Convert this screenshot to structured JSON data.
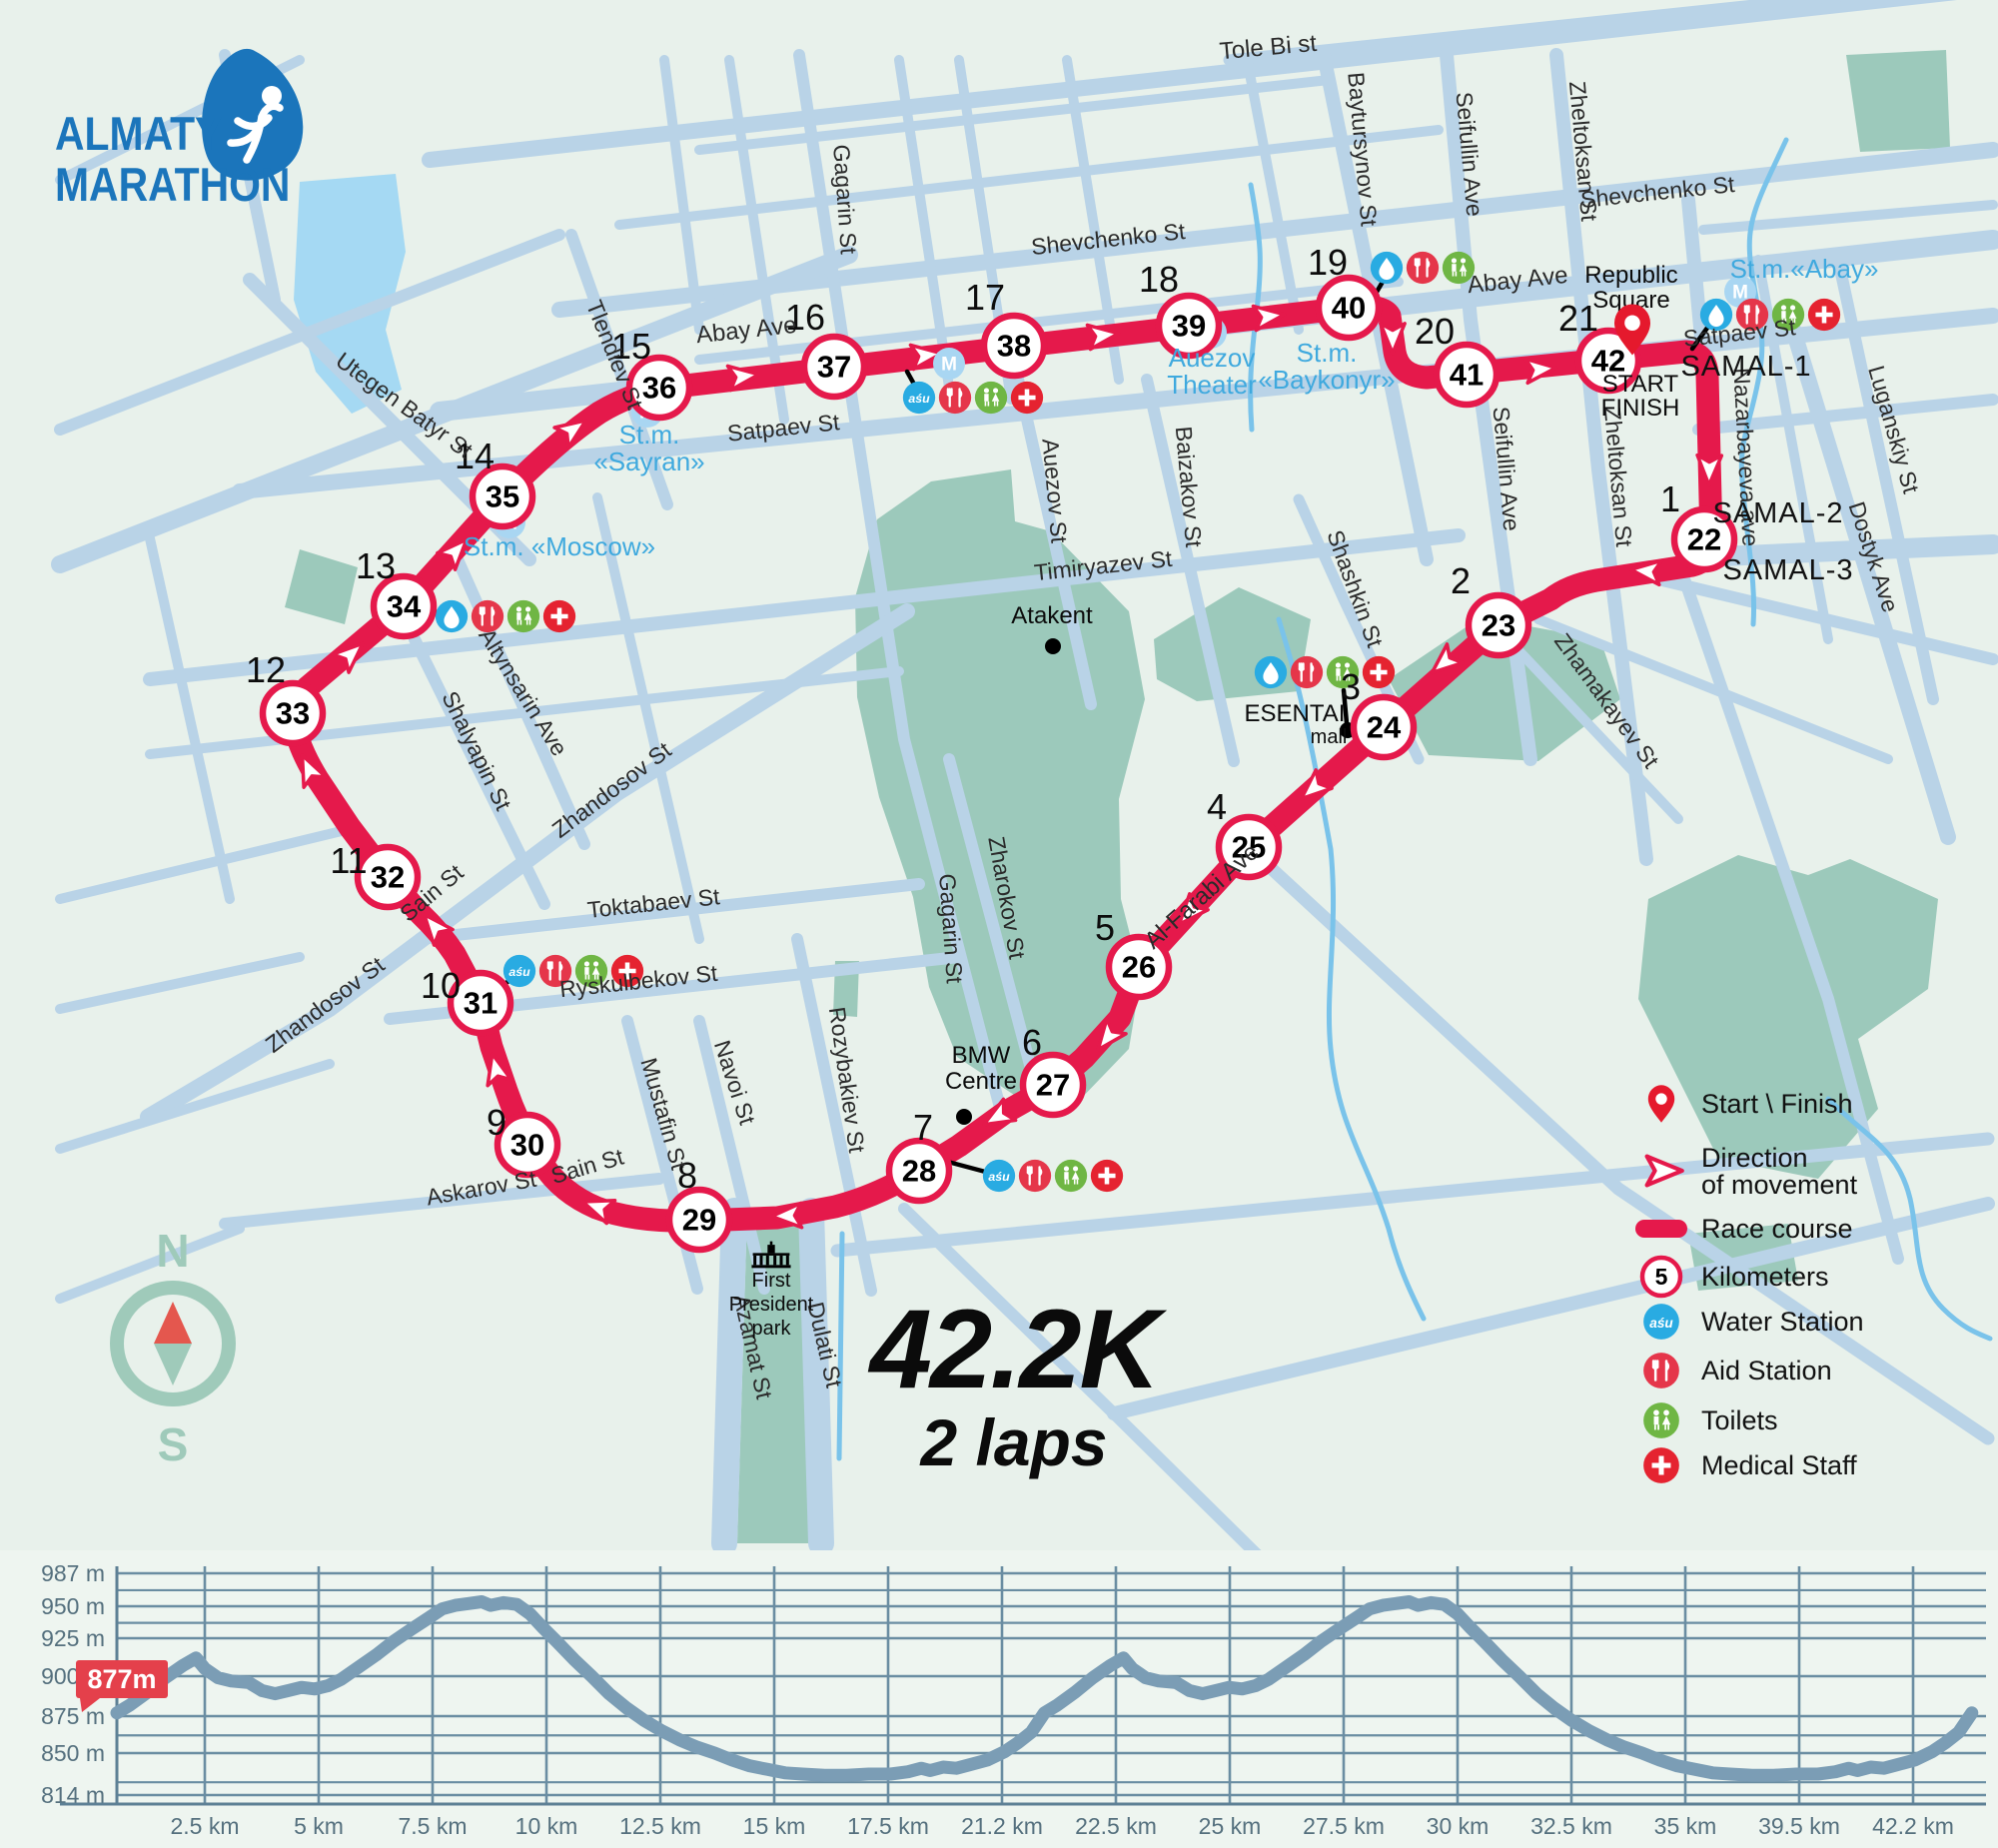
{
  "logo": {
    "line1": "ALMATY",
    "line2": "MARATHON"
  },
  "title": {
    "distance": "42.2K",
    "laps": "2 laps"
  },
  "compass": {
    "north": "N",
    "south": "S"
  },
  "legend": {
    "items": [
      {
        "icon": "pin",
        "label": "Start \\ Finish",
        "y": 1105
      },
      {
        "icon": "dir",
        "label": "Direction\nof movement",
        "y": 1172
      },
      {
        "icon": "bar",
        "label": "Race course",
        "y": 1230
      },
      {
        "icon": "km",
        "label": "Kilometers",
        "badge": "5",
        "y": 1278
      },
      {
        "icon": "asu",
        "label": "Water Station",
        "y": 1323
      },
      {
        "icon": "aid",
        "label": "Aid Station",
        "y": 1372
      },
      {
        "icon": "wc",
        "label": "Toilets",
        "y": 1422
      },
      {
        "icon": "med",
        "label": "Medical Staff",
        "y": 1467
      }
    ]
  },
  "map": {
    "colors": {
      "course": "#e5194b",
      "street": "#b9d3e7",
      "water": "#7ac3ea",
      "park": "#9cc9bb",
      "bg": "#e8f1eb"
    },
    "markers": [
      {
        "n": "22",
        "x": 1706,
        "y": 540,
        "k": "1",
        "kx": 1672,
        "ky": 512
      },
      {
        "n": "23",
        "x": 1500,
        "y": 626,
        "k": "2",
        "kx": 1462,
        "ky": 594
      },
      {
        "n": "24",
        "x": 1385,
        "y": 728,
        "k": "3",
        "kx": 1352,
        "ky": 700
      },
      {
        "n": "25",
        "x": 1250,
        "y": 848,
        "k": "4",
        "kx": 1218,
        "ky": 820
      },
      {
        "n": "26",
        "x": 1140,
        "y": 968,
        "k": "5",
        "kx": 1106,
        "ky": 941
      },
      {
        "n": "27",
        "x": 1054,
        "y": 1086,
        "k": "6",
        "kx": 1033,
        "ky": 1056
      },
      {
        "n": "28",
        "x": 920,
        "y": 1172,
        "k": "7",
        "kx": 924,
        "ky": 1141
      },
      {
        "n": "29",
        "x": 700,
        "y": 1221,
        "k": "8",
        "kx": 688,
        "ky": 1189
      },
      {
        "n": "30",
        "x": 528,
        "y": 1146,
        "k": "9",
        "kx": 497,
        "ky": 1136
      },
      {
        "n": "31",
        "x": 481,
        "y": 1004,
        "k": "10",
        "kx": 441,
        "ky": 999
      },
      {
        "n": "32",
        "x": 388,
        "y": 878,
        "k": "11",
        "kx": 349,
        "ky": 874
      },
      {
        "n": "33",
        "x": 293,
        "y": 714,
        "k": "12",
        "kx": 266,
        "ky": 683
      },
      {
        "n": "34",
        "x": 404,
        "y": 607,
        "k": "13",
        "kx": 376,
        "ky": 579
      },
      {
        "n": "35",
        "x": 503,
        "y": 497,
        "k": "14",
        "kx": 475,
        "ky": 469
      },
      {
        "n": "36",
        "x": 660,
        "y": 388,
        "k": "15",
        "kx": 632,
        "ky": 359
      },
      {
        "n": "37",
        "x": 835,
        "y": 367,
        "k": "16",
        "kx": 806,
        "ky": 330
      },
      {
        "n": "38",
        "x": 1015,
        "y": 346,
        "k": "17",
        "kx": 986,
        "ky": 310
      },
      {
        "n": "39",
        "x": 1190,
        "y": 326,
        "k": "18",
        "kx": 1160,
        "ky": 292
      },
      {
        "n": "40",
        "x": 1350,
        "y": 308,
        "k": "19",
        "kx": 1329,
        "ky": 275
      },
      {
        "n": "41",
        "x": 1468,
        "y": 375,
        "k": "20",
        "kx": 1436,
        "ky": 344
      },
      {
        "n": "42",
        "x": 1610,
        "y": 361,
        "k": "21",
        "kx": 1580,
        "ky": 331
      }
    ],
    "labels": [
      {
        "t": "Tole Bi st",
        "x": 1270,
        "y": 55,
        "r": -5,
        "c": "stl"
      },
      {
        "t": "Shevchenko St",
        "x": 1110,
        "y": 247,
        "r": -6,
        "c": "st"
      },
      {
        "t": "Shevchenko St",
        "x": 1660,
        "y": 200,
        "r": -6,
        "c": "st"
      },
      {
        "t": "Abay Ave",
        "x": 748,
        "y": 338,
        "r": -6,
        "c": "stl"
      },
      {
        "t": "Abay Ave",
        "x": 1520,
        "y": 288,
        "r": -6,
        "c": "stl"
      },
      {
        "t": "Satpaev St",
        "x": 785,
        "y": 436,
        "r": -6,
        "c": "st"
      },
      {
        "t": "Satpaev St",
        "x": 1742,
        "y": 341,
        "r": -6,
        "c": "st"
      },
      {
        "t": "Timiryazev St",
        "x": 1105,
        "y": 574,
        "r": -6,
        "c": "st"
      },
      {
        "t": "Gagarin St",
        "x": 838,
        "y": 200,
        "r": 86,
        "c": "st"
      },
      {
        "t": "Gagarin St",
        "x": 944,
        "y": 930,
        "r": 86,
        "c": "st"
      },
      {
        "t": "Baytursynov St",
        "x": 1356,
        "y": 150,
        "r": 85,
        "c": "st"
      },
      {
        "t": "Seifullin Ave",
        "x": 1463,
        "y": 155,
        "r": 85,
        "c": "st"
      },
      {
        "t": "Seifullin Ave",
        "x": 1500,
        "y": 470,
        "r": 85,
        "c": "st"
      },
      {
        "t": "Zheltoksan St",
        "x": 1577,
        "y": 152,
        "r": 85,
        "c": "st"
      },
      {
        "t": "Zheltoksan St",
        "x": 1612,
        "y": 478,
        "r": 85,
        "c": "st"
      },
      {
        "t": "Nazarbayeva ave",
        "x": 1740,
        "y": 458,
        "r": 87,
        "c": "st"
      },
      {
        "t": "Luganskiy St",
        "x": 1888,
        "y": 432,
        "r": 74,
        "c": "st"
      },
      {
        "t": "Dostyk Ave",
        "x": 1868,
        "y": 560,
        "r": 72,
        "c": "st"
      },
      {
        "t": "Zhamakayev St",
        "x": 1602,
        "y": 706,
        "r": 54,
        "c": "st"
      },
      {
        "t": "Shashkin St",
        "x": 1349,
        "y": 592,
        "r": 70,
        "c": "st"
      },
      {
        "t": "Auezov St",
        "x": 1048,
        "y": 492,
        "r": 85,
        "c": "st"
      },
      {
        "t": "Baizakov St",
        "x": 1182,
        "y": 488,
        "r": 85,
        "c": "st"
      },
      {
        "t": "Zharokov St",
        "x": 1000,
        "y": 900,
        "r": 80,
        "c": "st"
      },
      {
        "t": "Rozybakiev St",
        "x": 840,
        "y": 1082,
        "r": 82,
        "c": "st"
      },
      {
        "t": "Al-Farabi Ave",
        "x": 1208,
        "y": 903,
        "r": -42,
        "c": "stl"
      },
      {
        "t": "Utegen Batyr St",
        "x": 400,
        "y": 412,
        "r": 36,
        "c": "st"
      },
      {
        "t": "Tlendiev St",
        "x": 608,
        "y": 358,
        "r": 68,
        "c": "st"
      },
      {
        "t": "Altynsarin Ave",
        "x": 517,
        "y": 697,
        "r": 58,
        "c": "st"
      },
      {
        "t": "Shalyapin St",
        "x": 470,
        "y": 755,
        "r": 64,
        "c": "st"
      },
      {
        "t": "Zhandosov St",
        "x": 330,
        "y": 1012,
        "r": -37,
        "c": "st"
      },
      {
        "t": "Zhandosov St",
        "x": 617,
        "y": 797,
        "r": -37,
        "c": "st"
      },
      {
        "t": "Toktabaev St",
        "x": 655,
        "y": 912,
        "r": -6,
        "c": "st"
      },
      {
        "t": "Ryskulbekov St",
        "x": 640,
        "y": 990,
        "r": -6,
        "c": "st"
      },
      {
        "t": "Sain St",
        "x": 437,
        "y": 900,
        "r": -40,
        "c": "st"
      },
      {
        "t": "Sain St",
        "x": 590,
        "y": 1175,
        "r": -16,
        "c": "st"
      },
      {
        "t": "Askarov St",
        "x": 483,
        "y": 1197,
        "r": -10,
        "c": "st"
      },
      {
        "t": "Mustafin St",
        "x": 657,
        "y": 1117,
        "r": 74,
        "c": "st"
      },
      {
        "t": "Navoi St",
        "x": 728,
        "y": 1086,
        "r": 72,
        "c": "st"
      },
      {
        "t": "Dulati St",
        "x": 818,
        "y": 1348,
        "r": 77,
        "c": "st"
      },
      {
        "t": "Azamat St",
        "x": 746,
        "y": 1350,
        "r": 77,
        "c": "st"
      },
      {
        "t": "SAMAL-1",
        "x": 1748,
        "y": 376,
        "r": 0,
        "c": "dist"
      },
      {
        "t": "SAMAL-2",
        "x": 1780,
        "y": 523,
        "r": 0,
        "c": "dist"
      },
      {
        "t": "SAMAL-3",
        "x": 1790,
        "y": 580,
        "r": 0,
        "c": "dist"
      },
      {
        "t": "Republic",
        "x": 1633,
        "y": 283,
        "r": 0,
        "c": "pl"
      },
      {
        "t": "Square",
        "x": 1633,
        "y": 308,
        "r": 0,
        "c": "pl"
      },
      {
        "t": "START",
        "x": 1642,
        "y": 392,
        "r": 0,
        "c": "pl"
      },
      {
        "t": "FINISH",
        "x": 1642,
        "y": 416,
        "r": 0,
        "c": "pl"
      },
      {
        "t": "Atakent",
        "x": 1053,
        "y": 624,
        "r": 0,
        "c": "pl"
      },
      {
        "t": "BMW",
        "x": 982,
        "y": 1064,
        "r": 0,
        "c": "pl"
      },
      {
        "t": "Centre",
        "x": 982,
        "y": 1090,
        "r": 0,
        "c": "pl"
      },
      {
        "t": "ESENTAI",
        "x": 1296,
        "y": 722,
        "r": 0,
        "c": "pl"
      },
      {
        "t": "mall",
        "x": 1330,
        "y": 744,
        "r": 0,
        "c": "pls"
      },
      {
        "t": "First",
        "x": 772,
        "y": 1288,
        "r": 0,
        "c": "pls"
      },
      {
        "t": "President",
        "x": 772,
        "y": 1312,
        "r": 0,
        "c": "pls"
      },
      {
        "t": "park",
        "x": 772,
        "y": 1336,
        "r": 0,
        "c": "pls"
      },
      {
        "t": "St.m.",
        "x": 650,
        "y": 444,
        "r": 0,
        "c": "met"
      },
      {
        "t": "«Sayran»",
        "x": 650,
        "y": 471,
        "r": 0,
        "c": "met"
      },
      {
        "t": "St.m. «Moscow»",
        "x": 560,
        "y": 556,
        "r": 0,
        "c": "met"
      },
      {
        "t": "Auezov",
        "x": 1213,
        "y": 367,
        "r": 0,
        "c": "met"
      },
      {
        "t": "Theater",
        "x": 1213,
        "y": 394,
        "r": 0,
        "c": "met"
      },
      {
        "t": "St.m.",
        "x": 1328,
        "y": 362,
        "r": 0,
        "c": "met"
      },
      {
        "t": "«Baykonyr»",
        "x": 1328,
        "y": 389,
        "r": 0,
        "c": "met"
      },
      {
        "t": "St.m.«Abay»",
        "x": 1806,
        "y": 278,
        "r": 0,
        "c": "met"
      }
    ],
    "metro_m": [
      [
        648,
        412
      ],
      [
        510,
        523
      ],
      [
        1212,
        333
      ],
      [
        1742,
        292
      ],
      [
        950,
        364
      ]
    ],
    "dots": [
      [
        1054,
        647
      ],
      [
        965,
        1118
      ],
      [
        1349,
        731
      ]
    ],
    "pin": {
      "x": 1634,
      "y": 330
    },
    "stations": [
      {
        "x": 920,
        "y": 398,
        "icons": [
          "asu",
          "aid",
          "wc",
          "med"
        ]
      },
      {
        "x": 1388,
        "y": 268,
        "icons": [
          "drop",
          "aid",
          "wc"
        ]
      },
      {
        "x": 1718,
        "y": 315,
        "icons": [
          "drop",
          "aid",
          "wc",
          "med"
        ]
      },
      {
        "x": 1272,
        "y": 673,
        "icons": [
          "drop",
          "aid",
          "wc",
          "med"
        ]
      },
      {
        "x": 1000,
        "y": 1177,
        "icons": [
          "asu",
          "aid",
          "wc",
          "med"
        ]
      },
      {
        "x": 520,
        "y": 972,
        "icons": [
          "asu",
          "aid",
          "wc",
          "med"
        ]
      },
      {
        "x": 452,
        "y": 617,
        "icons": [
          "drop",
          "aid",
          "wc",
          "med"
        ]
      }
    ],
    "connectors": [
      [
        908,
        372,
        918,
        390
      ],
      [
        1370,
        306,
        1384,
        282
      ],
      [
        1694,
        349,
        1712,
        324
      ],
      [
        1345,
        691,
        1348,
        724
      ],
      [
        945,
        1162,
        990,
        1174
      ],
      [
        489,
        997,
        512,
        980
      ],
      [
        424,
        609,
        444,
        615
      ]
    ],
    "arrows": [
      {
        "x": 742,
        "y": 377,
        "a": -7
      },
      {
        "x": 925,
        "y": 356,
        "a": -7
      },
      {
        "x": 1102,
        "y": 336,
        "a": -7
      },
      {
        "x": 1268,
        "y": 317,
        "a": -7
      },
      {
        "x": 1394,
        "y": 336,
        "a": 90
      },
      {
        "x": 1540,
        "y": 370,
        "a": -6
      },
      {
        "x": 1711,
        "y": 468,
        "a": 91
      },
      {
        "x": 1650,
        "y": 572,
        "a": 186
      },
      {
        "x": 1447,
        "y": 662,
        "a": 140
      },
      {
        "x": 1316,
        "y": 788,
        "a": 139
      },
      {
        "x": 1192,
        "y": 912,
        "a": 131
      },
      {
        "x": 1110,
        "y": 1037,
        "a": 128
      },
      {
        "x": 1000,
        "y": 1117,
        "a": 150
      },
      {
        "x": 790,
        "y": 1217,
        "a": 178
      },
      {
        "x": 600,
        "y": 1209,
        "a": 200
      },
      {
        "x": 497,
        "y": 1072,
        "a": 256
      },
      {
        "x": 436,
        "y": 929,
        "a": 230
      },
      {
        "x": 310,
        "y": 772,
        "a": 245
      },
      {
        "x": 350,
        "y": 656,
        "a": -42
      },
      {
        "x": 455,
        "y": 553,
        "a": -47
      },
      {
        "x": 572,
        "y": 431,
        "a": -35
      }
    ]
  },
  "chart_data": {
    "type": "area",
    "title": "Elevation profile, 42.2 km, 2 laps",
    "xlabel": "distance, km",
    "ylabel": "elevation, m",
    "laps": 2,
    "lap_km": 21.1,
    "total_km": 42.2,
    "start_elevation_label": "877m",
    "x_ticks": [
      "2.5 km",
      "5 km",
      "7.5 km",
      "10 km",
      "12.5 km",
      "15 km",
      "17.5 km",
      "21.2 km",
      "22.5 km",
      "25 km",
      "27.5 km",
      "30 km",
      "32.5 km",
      "35 km",
      "39.5 km",
      "42.2 km"
    ],
    "y_ticks": [
      {
        "v": 987,
        "label": "987 m"
      },
      {
        "v": 950,
        "label": "950 m"
      },
      {
        "v": 925,
        "label": "925 m"
      },
      {
        "v": 900,
        "label": "900 m"
      },
      {
        "v": 875,
        "label": "875 m"
      },
      {
        "v": 850,
        "label": "850 m"
      },
      {
        "v": 814,
        "label": "814 m"
      }
    ],
    "y_grid_minor": [
      968,
      937,
      862,
      825
    ],
    "ylim": [
      814,
      987
    ],
    "lap_profile": [
      [
        0,
        877
      ],
      [
        0.3,
        882
      ],
      [
        0.7,
        890
      ],
      [
        1.1,
        899
      ],
      [
        1.5,
        907
      ],
      [
        1.8,
        912
      ],
      [
        2.0,
        905
      ],
      [
        2.3,
        899
      ],
      [
        2.6,
        897
      ],
      [
        3.0,
        896
      ],
      [
        3.3,
        891
      ],
      [
        3.6,
        889
      ],
      [
        3.9,
        891
      ],
      [
        4.2,
        893
      ],
      [
        4.5,
        892
      ],
      [
        4.8,
        894
      ],
      [
        5.1,
        898
      ],
      [
        5.5,
        906
      ],
      [
        5.9,
        914
      ],
      [
        6.3,
        923
      ],
      [
        6.7,
        932
      ],
      [
        7.1,
        941
      ],
      [
        7.4,
        948
      ],
      [
        7.7,
        951
      ],
      [
        8.0,
        953
      ],
      [
        8.3,
        955
      ],
      [
        8.5,
        951
      ],
      [
        8.8,
        954
      ],
      [
        9.1,
        952
      ],
      [
        9.4,
        944
      ],
      [
        9.7,
        933
      ],
      [
        10.0,
        923
      ],
      [
        10.4,
        911
      ],
      [
        10.8,
        900
      ],
      [
        11.2,
        889
      ],
      [
        11.6,
        880
      ],
      [
        12.0,
        872
      ],
      [
        12.4,
        865
      ],
      [
        12.8,
        859
      ],
      [
        13.2,
        854
      ],
      [
        13.6,
        850
      ],
      [
        14.0,
        844
      ],
      [
        14.4,
        839
      ],
      [
        14.8,
        836
      ],
      [
        15.2,
        833
      ],
      [
        15.6,
        832
      ],
      [
        16.1,
        831
      ],
      [
        16.6,
        831
      ],
      [
        17.1,
        832
      ],
      [
        17.6,
        832
      ],
      [
        18.0,
        834
      ],
      [
        18.3,
        837
      ],
      [
        18.5,
        835
      ],
      [
        18.8,
        838
      ],
      [
        19.1,
        837
      ],
      [
        19.4,
        840
      ],
      [
        19.8,
        844
      ],
      [
        20.2,
        851
      ],
      [
        20.5,
        857
      ],
      [
        20.8,
        864
      ],
      [
        21.1,
        877
      ]
    ]
  }
}
